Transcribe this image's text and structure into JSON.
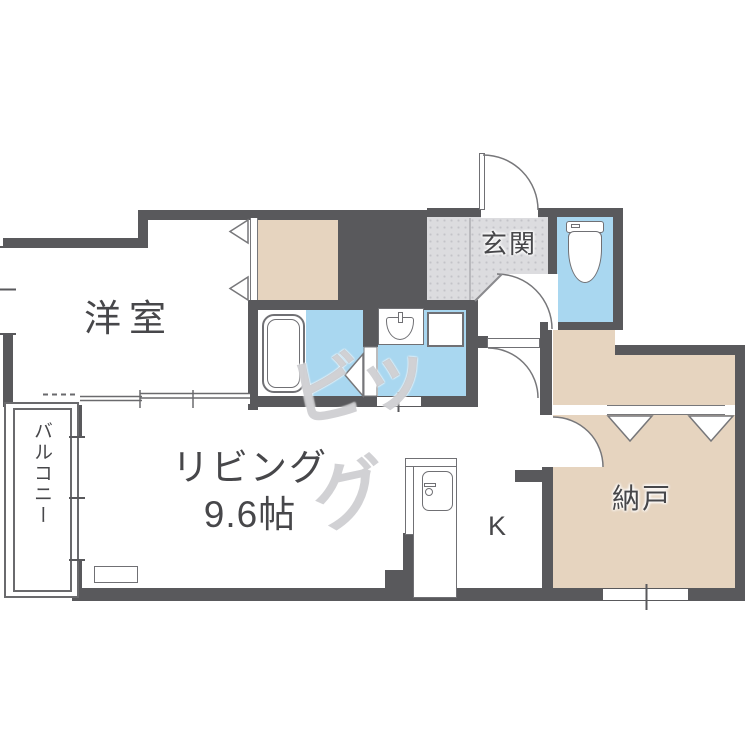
{
  "floorplan": {
    "rooms": {
      "western_room": {
        "label": "洋室"
      },
      "living": {
        "label": "リビング",
        "size_label": "9.6帖"
      },
      "kitchen": {
        "label": "K"
      },
      "entrance": {
        "label": "玄関"
      },
      "storage": {
        "label": "納戸"
      },
      "balcony": {
        "label": "バルコニー"
      }
    },
    "watermark": {
      "text": "ビッグ"
    },
    "colors": {
      "wall": "#59595c",
      "closet_floor": "#e6d4bf",
      "wet_area_floor": "#a9d7f0",
      "entrance_floor": "#dcdcdf",
      "label_text": "#47474a",
      "fixture_line": "#707074",
      "watermark_gray": "#9898a0"
    }
  }
}
